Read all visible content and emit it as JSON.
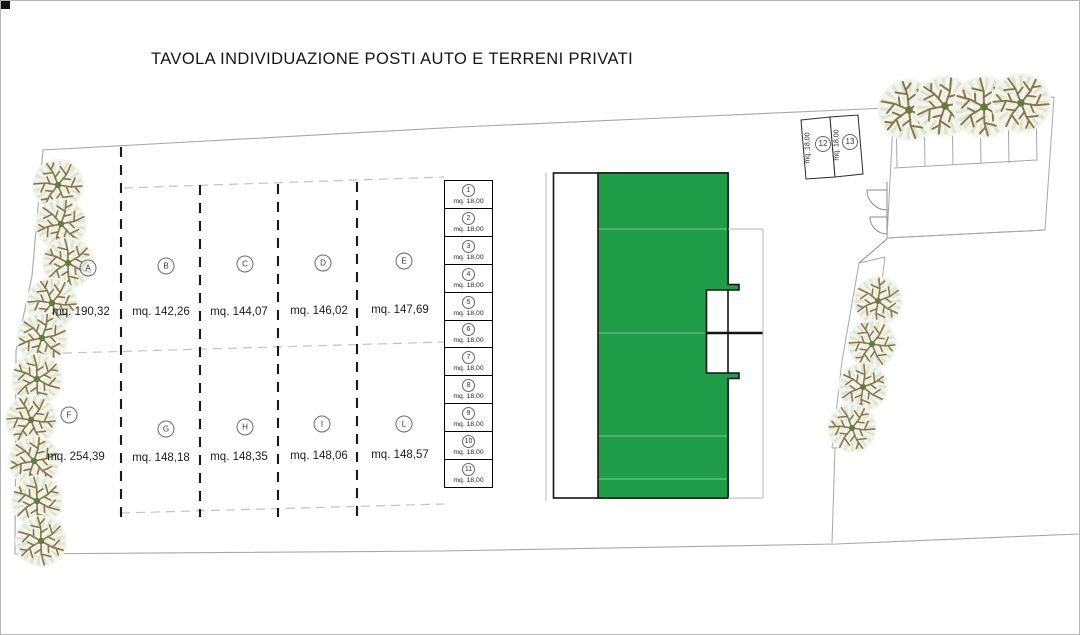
{
  "title": "TAVOLA INDIVIDUAZIONE POSTI AUTO E TERRENI PRIVATI",
  "plots": {
    "row1": [
      {
        "id": "A",
        "area": "mq. 190,32"
      },
      {
        "id": "B",
        "area": "mq. 142,26"
      },
      {
        "id": "C",
        "area": "mq. 144,07"
      },
      {
        "id": "D",
        "area": "mq. 146,02"
      },
      {
        "id": "E",
        "area": "mq. 147,69"
      }
    ],
    "row2": [
      {
        "id": "F",
        "area": "mq. 254,39"
      },
      {
        "id": "G",
        "area": "mq. 148,18"
      },
      {
        "id": "H",
        "area": "mq. 148,35"
      },
      {
        "id": "I",
        "area": "mq. 148,06"
      },
      {
        "id": "L",
        "area": "mq. 148,57"
      }
    ]
  },
  "parking_spaces": [
    {
      "id": "1",
      "area": "mq. 18,00"
    },
    {
      "id": "2",
      "area": "mq. 18,00"
    },
    {
      "id": "3",
      "area": "mq. 18,00"
    },
    {
      "id": "4",
      "area": "mq. 18,00"
    },
    {
      "id": "5",
      "area": "mq. 18,00"
    },
    {
      "id": "6",
      "area": "mq. 18,00"
    },
    {
      "id": "7",
      "area": "mq. 18,00"
    },
    {
      "id": "8",
      "area": "mq. 18,00"
    },
    {
      "id": "9",
      "area": "mq. 18,00"
    },
    {
      "id": "10",
      "area": "mq. 18,00"
    },
    {
      "id": "11",
      "area": "mq. 18,00"
    }
  ],
  "side_parking_spaces": [
    {
      "id": "12",
      "area": "mq. 18,00"
    },
    {
      "id": "13",
      "area": "mq. 18,00"
    }
  ],
  "colors": {
    "building_green": "#1f9d48",
    "boundary_gray": "#a8a8a8",
    "outline_black": "#141414"
  }
}
